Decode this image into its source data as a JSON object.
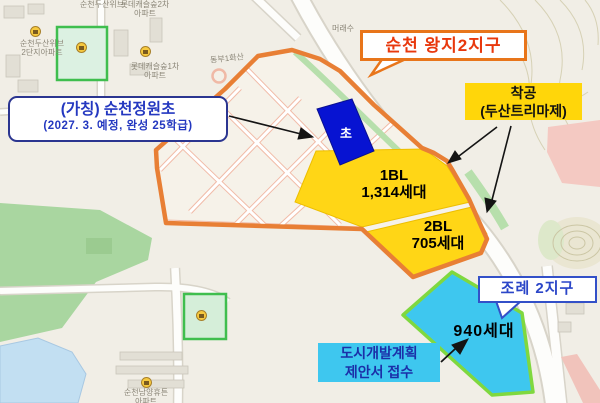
{
  "region_callouts": {
    "wangji_district": "순천 왕지2지구",
    "jorye_district": "조례 2지구"
  },
  "annotations": {
    "chakgong_line1": "착공",
    "chakgong_line2": "(두산트리마제)",
    "school_line1": "(가칭) 순천정원초",
    "school_line2": "(2027. 3. 예정, 완성 25학급)",
    "proposal_line1": "도시개발계획",
    "proposal_line2": "제안서 접수",
    "households_940": "940세대"
  },
  "parcels": {
    "bl1_name": "1BL",
    "bl1_households": "1,314세대",
    "bl2_name": "2BL",
    "bl2_households": "705세대",
    "school_site": "초"
  },
  "map_labels": {
    "apt_dusan_weve": "순천두산위브",
    "apt_dusan_weve2_line1": "순천두산위브",
    "apt_dusan_weve2_line2": "2단지아파트",
    "apt_lotte_castle2_line1": "롯데캐슬숲2차",
    "apt_lotte_castle2_line2": "아파트",
    "apt_lotte_castle1_line1": "롯데캐슬숲1차",
    "apt_lotte_castle1_line2": "아파트",
    "road_dongbu": "동부1화산",
    "stream_maeraesu": "머래수",
    "apt_namyang_line1": "순천남양휴튼",
    "apt_namyang_line2": "아파트"
  },
  "colors": {
    "district_boundary_orange": "#E87F35",
    "block_yellow": "#FFD616",
    "school_site_blue": "#0713D2",
    "jorye_site_cyan": "#3EC7EF",
    "jorye_site_border_green": "#7FD83F",
    "wangji_text_red": "#E8380D",
    "annotation_blue": "#2438C0"
  }
}
